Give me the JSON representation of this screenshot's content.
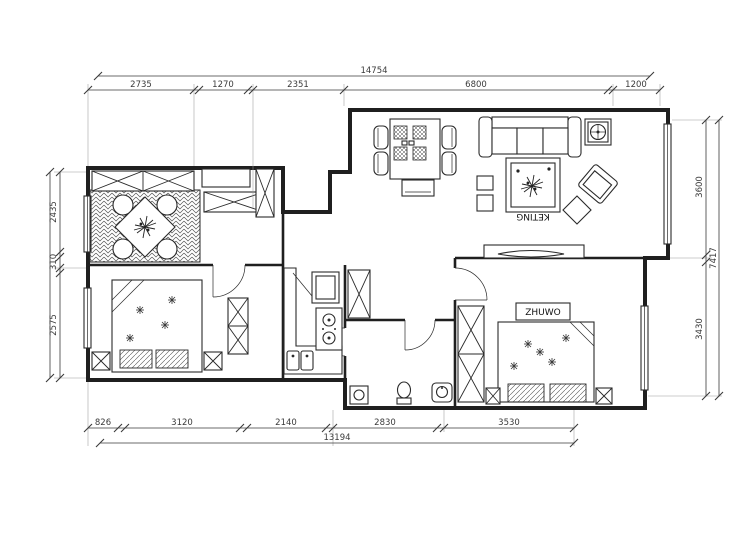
{
  "title": "apartment-floor-plan",
  "colors": {
    "wall": "#1f1f1f",
    "line": "#2a2a2a",
    "dim": "#3a3a3a",
    "background": "#ffffff"
  },
  "room_labels": {
    "master_bedroom": "ZHUWO",
    "living_room": "KETING"
  },
  "dimensions": {
    "top": {
      "total": "14754",
      "segments": [
        "2735",
        "1270",
        "2351",
        "6800",
        "1200"
      ]
    },
    "bottom": {
      "total": "13194",
      "segments": [
        "826",
        "3120",
        "2140",
        "2830",
        "3530"
      ]
    },
    "left": {
      "segments": [
        "2435",
        "310",
        "2575"
      ]
    },
    "right": {
      "total": "7417",
      "segments": [
        "3600",
        "3430"
      ]
    }
  }
}
